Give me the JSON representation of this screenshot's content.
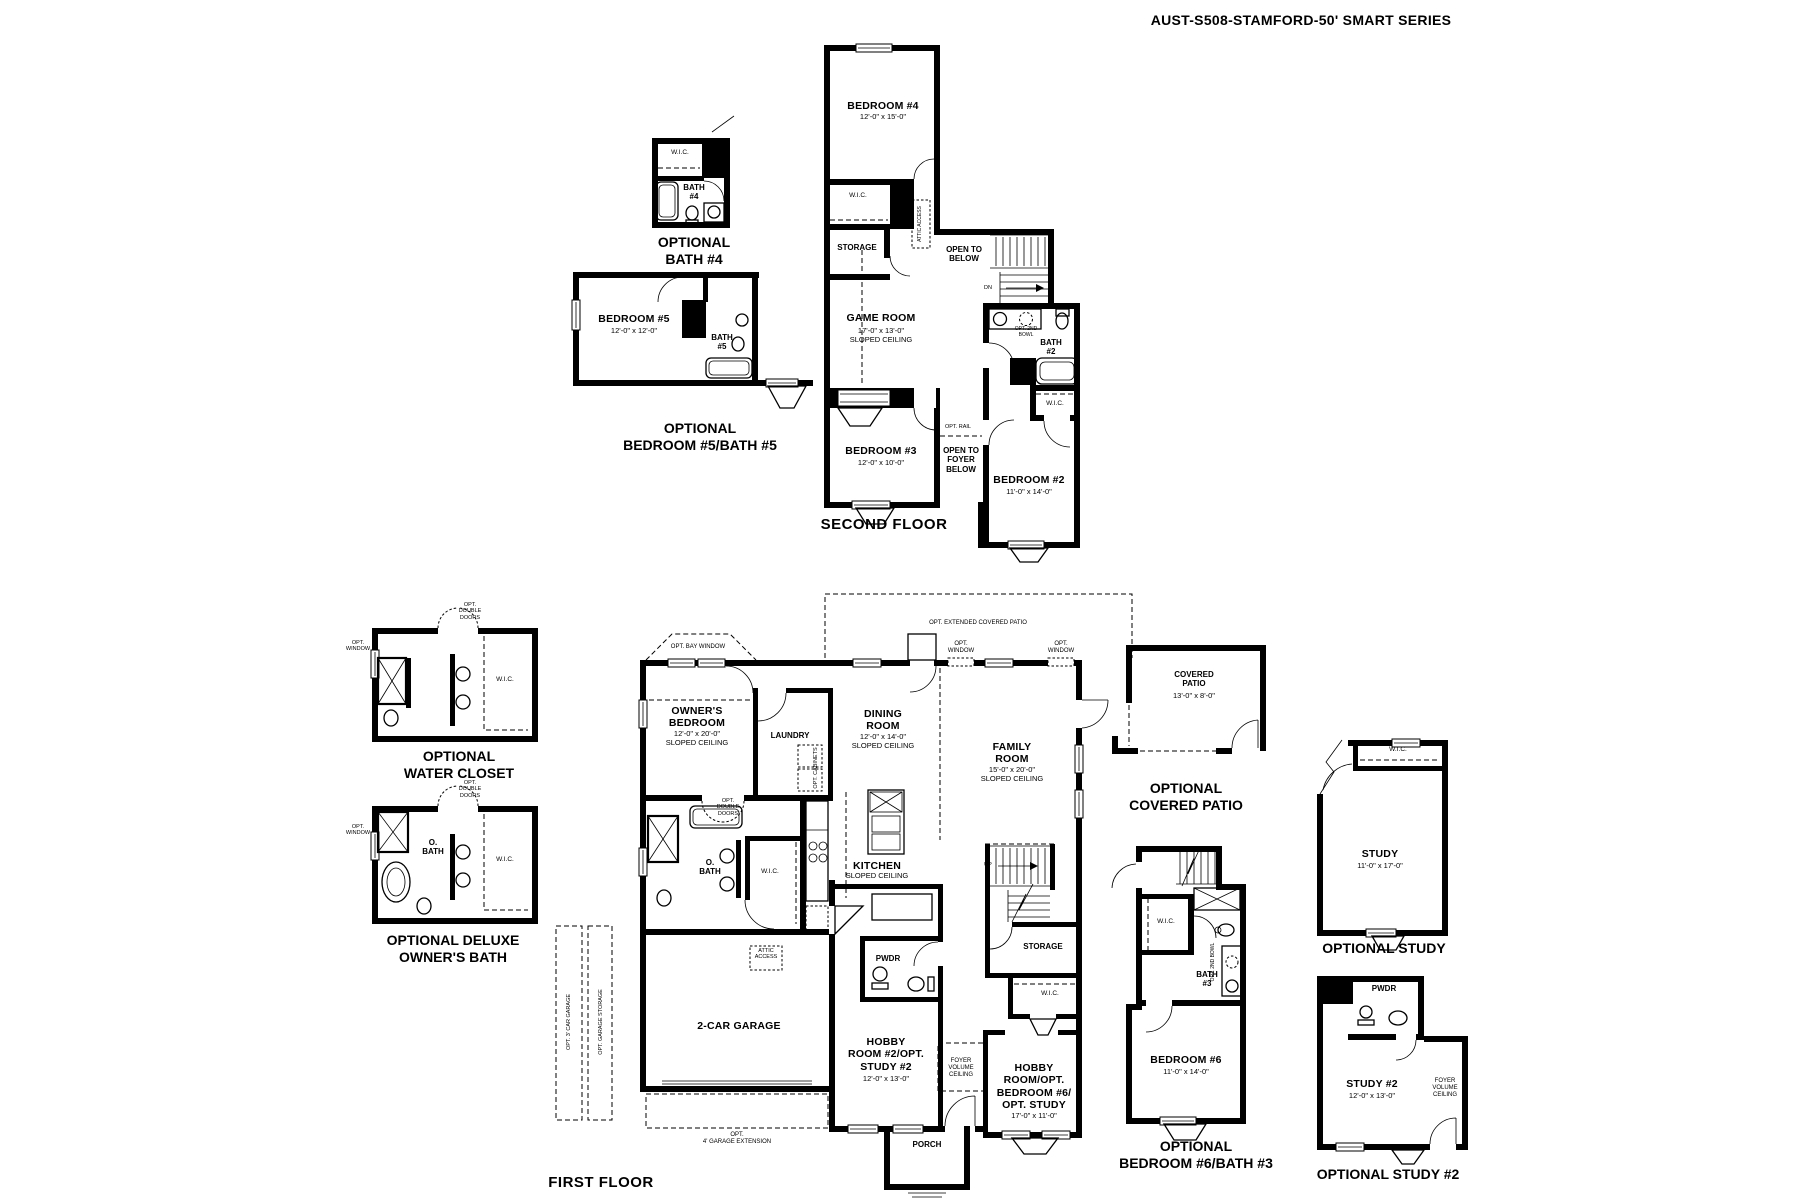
{
  "title": "AUST-S508-STAMFORD-50' SMART SERIES",
  "colors": {
    "line": "#000000",
    "background": "#ffffff"
  },
  "second_floor": {
    "floor_label": "SECOND FLOOR",
    "bedroom4_name": "BEDROOM #4",
    "bedroom4_dims": "12'-0\" x 15'-0\"",
    "wic": "W.I.C.",
    "storage": "STORAGE",
    "attic_access": "ATTIC ACCESS",
    "open_to_below": "OPEN TO\nBELOW",
    "dn": "DN",
    "opt_2nd_bowl": "OPT. 2ND\nBOWL",
    "bath2": "BATH\n#2",
    "game_room_name": "GAME ROOM",
    "game_room_dims": "17'-0\" x 13'-0\"\nSLOPED CEILING",
    "opt_rail": "OPT. RAIL",
    "bedroom3_name": "BEDROOM #3",
    "bedroom3_dims": "12'-0\" x 10'-0\"",
    "open_to_foyer": "OPEN TO\nFOYER\nBELOW",
    "bedroom2_name": "BEDROOM #2",
    "bedroom2_dims": "11'-0\" x 14'-0\""
  },
  "first_floor": {
    "floor_label": "FIRST FLOOR",
    "opt_bay_window": "OPT. BAY WINDOW",
    "opt_extended_patio": "OPT. EXTENDED COVERED PATIO",
    "owners_name": "OWNER'S\nBEDROOM",
    "owners_dims": "12'-0\" x 20'-0\"\nSLOPED CEILING",
    "laundry": "LAUNDRY",
    "opt_cabinets": "OPT. CABINETS",
    "opt_window": "OPT.\nWINDOW",
    "dining_name": "DINING\nROOM",
    "dining_dims": "12'-0\" x 14'-0\"\nSLOPED CEILING",
    "family_name": "FAMILY\nROOM",
    "family_dims": "15'-0\" x 20'-0\"\nSLOPED CEILING",
    "kitchen_name": "KITCHEN",
    "kitchen_note": "SLOPED CEILING",
    "opt_double_doors": "OPT.\nDOUBLE\nDOORS",
    "o_bath": "O.\nBATH",
    "wic": "W.I.C.",
    "up": "UP",
    "attic_access": "ATTIC\nACCESS",
    "pwdr": "PWDR",
    "storage": "STORAGE",
    "garage": "2-CAR GARAGE",
    "hobby2_name": "HOBBY\nROOM #2/OPT.\nSTUDY #2",
    "hobby2_dims": "12'-0\" x 13'-0\"",
    "foyer": "FOYER\nVOLUME\nCEILING",
    "hobby_name": "HOBBY\nROOM/OPT.\nBEDROOM #6/\nOPT. STUDY",
    "hobby_dims": "17'-0\" x 11'-0\"",
    "porch": "PORCH",
    "opt_garage_ext": "OPT.\n4' GARAGE EXTENSION",
    "opt_3car": "OPT. 3' CAR GARAGE",
    "opt_garage_storage": "OPT. GARAGE STORAGE"
  },
  "insets": {
    "bath4": {
      "wic": "W.I.C.",
      "bath": "BATH\n#4",
      "label": "OPTIONAL\nBATH #4"
    },
    "bedroom5": {
      "name": "BEDROOM #5",
      "dims": "12'-0\" x 12'-0\"",
      "bath": "BATH\n#5",
      "label": "OPTIONAL\nBEDROOM #5/BATH #5"
    },
    "water_closet": {
      "opt_double_doors": "OPT.\nDOUBLE\nDOORS",
      "opt_window": "OPT.\nWINDOW",
      "wic": "W.I.C.",
      "label": "OPTIONAL\nWATER CLOSET"
    },
    "deluxe_bath": {
      "opt_double_doors": "OPT.\nDOUBLE\nDOORS",
      "opt_window": "OPT.\nWINDOW",
      "o_bath": "O.\nBATH",
      "wic": "W.I.C.",
      "label": "OPTIONAL DELUXE\nOWNER'S BATH"
    },
    "covered_patio": {
      "name": "COVERED\nPATIO",
      "dims": "13'-0\" x 8'-0\"",
      "label": "OPTIONAL\nCOVERED PATIO"
    },
    "study": {
      "wic": "W.I.C.",
      "name": "STUDY",
      "dims": "11'-0\" x 17'-0\"",
      "label": "OPTIONAL STUDY"
    },
    "bedroom6": {
      "wic": "W.I.C.",
      "opt_2nd_bowl": "OPT. 2ND BOWL",
      "bath3": "BATH\n#3",
      "name": "BEDROOM #6",
      "dims": "11'-0\" x 14'-0\"",
      "label": "OPTIONAL\nBEDROOM #6/BATH #3"
    },
    "study2": {
      "pwdr": "PWDR",
      "name": "STUDY #2",
      "dims": "12'-0\" x 13'-0\"",
      "foyer": "FOYER\nVOLUME\nCEILING",
      "label": "OPTIONAL STUDY #2"
    }
  }
}
